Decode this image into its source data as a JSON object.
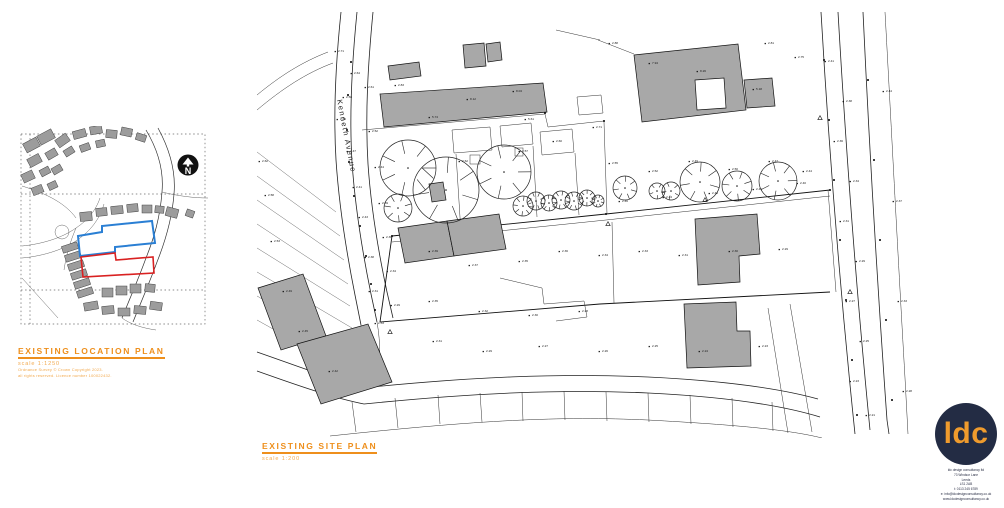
{
  "colors": {
    "accent_orange": "#ee8f1c",
    "orange_light": "#f2a94e",
    "boundary_blue": "#2a7fd4",
    "boundary_red": "#d92121",
    "logo_navy": "#232c44",
    "logo_orange": "#ef9b2d",
    "building_gray": "#a8a8a8"
  },
  "location_plan": {
    "title": "EXISTING LOCATION PLAN",
    "scale": "scale 1:1250",
    "note_line1": "Ordnance Survey © Crown Copyright 2023.",
    "note_line2": "all rights reserved. Licence number 100022432.",
    "north_label": "N"
  },
  "site_plan": {
    "title": "EXISTING SITE PLAN",
    "scale": "scale 1:200",
    "street_label": "Kenneth Avenue",
    "spot_levels": [
      [
        338,
        52,
        "2.71"
      ],
      [
        354,
        74,
        "2.64"
      ],
      [
        346,
        98,
        "2.58"
      ],
      [
        368,
        88,
        "2.61"
      ],
      [
        340,
        120,
        "2.66"
      ],
      [
        372,
        132,
        "2.52"
      ],
      [
        350,
        152,
        "2.47"
      ],
      [
        378,
        168,
        "2.44"
      ],
      [
        356,
        188,
        "2.41"
      ],
      [
        382,
        204,
        "2.39"
      ],
      [
        362,
        218,
        "2.43"
      ],
      [
        386,
        238,
        "2.36"
      ],
      [
        368,
        258,
        "2.38"
      ],
      [
        390,
        272,
        "2.34"
      ],
      [
        372,
        292,
        "2.31"
      ],
      [
        394,
        306,
        "2.29"
      ],
      [
        378,
        324,
        "2.33"
      ],
      [
        398,
        86,
        "2.83"
      ],
      [
        432,
        118,
        "5.74"
      ],
      [
        470,
        100,
        "8.12"
      ],
      [
        516,
        92,
        "8.04"
      ],
      [
        528,
        120,
        "5.61"
      ],
      [
        612,
        44,
        "2.88"
      ],
      [
        652,
        64,
        "7.94"
      ],
      [
        700,
        72,
        "8.26"
      ],
      [
        756,
        90,
        "5.18"
      ],
      [
        798,
        58,
        "2.75"
      ],
      [
        768,
        44,
        "2.81"
      ],
      [
        462,
        162,
        "2.62"
      ],
      [
        522,
        152,
        "2.57"
      ],
      [
        556,
        142,
        "2.60"
      ],
      [
        596,
        128,
        "2.71"
      ],
      [
        612,
        164,
        "2.55"
      ],
      [
        652,
        172,
        "2.52"
      ],
      [
        692,
        162,
        "2.49"
      ],
      [
        732,
        170,
        "2.50"
      ],
      [
        772,
        162,
        "2.47"
      ],
      [
        806,
        172,
        "2.44"
      ],
      [
        622,
        202,
        "2.46"
      ],
      [
        666,
        198,
        "2.44"
      ],
      [
        712,
        194,
        "2.43"
      ],
      [
        756,
        190,
        "2.41"
      ],
      [
        800,
        184,
        "2.40"
      ],
      [
        432,
        252,
        "2.39"
      ],
      [
        472,
        266,
        "2.37"
      ],
      [
        522,
        262,
        "2.35"
      ],
      [
        562,
        252,
        "2.36"
      ],
      [
        602,
        256,
        "2.34"
      ],
      [
        642,
        252,
        "2.33"
      ],
      [
        682,
        256,
        "2.31"
      ],
      [
        732,
        252,
        "2.30"
      ],
      [
        782,
        250,
        "2.29"
      ],
      [
        432,
        302,
        "2.35"
      ],
      [
        482,
        312,
        "2.32"
      ],
      [
        532,
        316,
        "2.30"
      ],
      [
        582,
        312,
        "2.28"
      ],
      [
        436,
        342,
        "2.31"
      ],
      [
        486,
        352,
        "2.29"
      ],
      [
        542,
        347,
        "2.27"
      ],
      [
        602,
        352,
        "2.26"
      ],
      [
        652,
        347,
        "2.25"
      ],
      [
        702,
        352,
        "2.24"
      ],
      [
        762,
        347,
        "2.23"
      ],
      [
        828,
        62,
        "2.41"
      ],
      [
        846,
        102,
        "2.38"
      ],
      [
        837,
        142,
        "2.36"
      ],
      [
        853,
        182,
        "2.34"
      ],
      [
        843,
        222,
        "2.31"
      ],
      [
        859,
        262,
        "2.29"
      ],
      [
        849,
        302,
        "2.27"
      ],
      [
        863,
        342,
        "2.25"
      ],
      [
        853,
        382,
        "2.23"
      ],
      [
        869,
        416,
        "2.21"
      ],
      [
        886,
        92,
        "2.44"
      ],
      [
        896,
        202,
        "2.37"
      ],
      [
        901,
        302,
        "2.33"
      ],
      [
        906,
        392,
        "2.28"
      ],
      [
        332,
        372,
        "2.42"
      ],
      [
        302,
        332,
        "2.45"
      ],
      [
        286,
        292,
        "2.49"
      ],
      [
        274,
        242,
        "2.53"
      ],
      [
        268,
        196,
        "2.58"
      ],
      [
        262,
        162,
        "2.62"
      ]
    ]
  },
  "logo": {
    "monogram": "ldc",
    "lines": [
      "ldc design consultancy ltd",
      "73 Windsor Lane",
      "Leeds",
      "LS1 2AB",
      "t: 0113 245 6789",
      "e: info@ldcdesignconsultancy.co.uk",
      "www.ldcdesignconsultancy.co.uk"
    ]
  }
}
